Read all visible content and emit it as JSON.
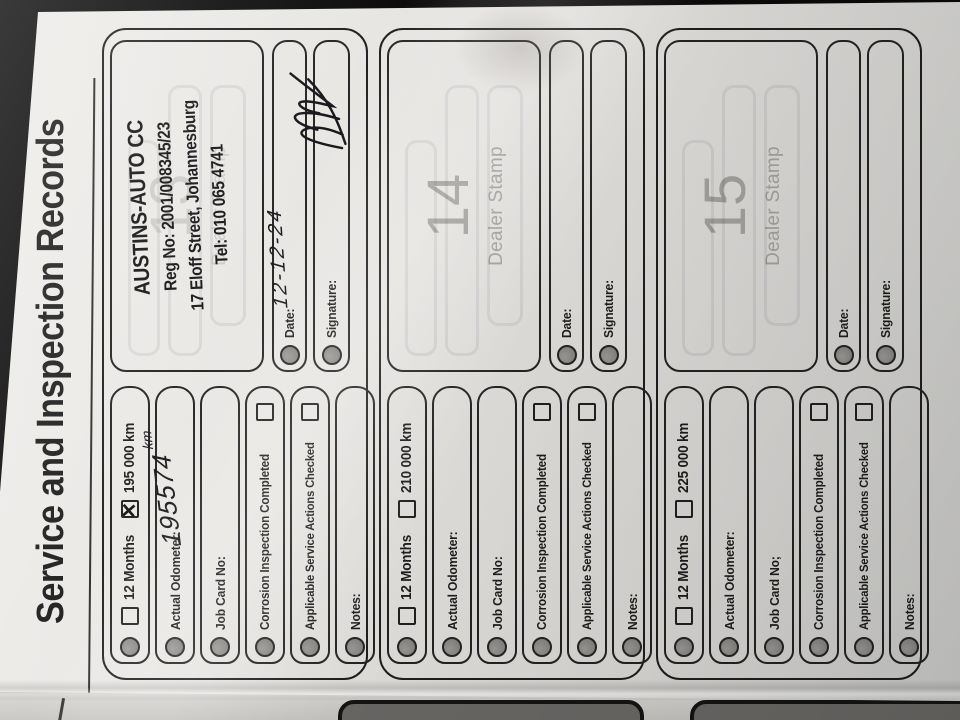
{
  "page": {
    "title": "Service and Inspection Records"
  },
  "records": [
    {
      "number": "13",
      "print_faint": true,
      "dealer_stamp_label": "Dealer Stamp",
      "has_stamp": true,
      "stamp": {
        "name": "AUSTINS-AUTO CC",
        "reg": "Reg No: 2001/008345/23",
        "street": "17 Eloff Street, Johannesburg",
        "tel": "Tel: 010 065 4741"
      },
      "fields": {
        "interval_label": "12 Months",
        "interval_checked": false,
        "km_label": "195 000 km",
        "km_checked": true,
        "odometer_label": "Actual Odometer:",
        "odometer_value": "195574",
        "odometer_unit": "km",
        "job_card_label": "Job Card No:",
        "corrosion_label": "Corrosion Inspection Completed",
        "corrosion_checked": false,
        "actions_label": "Applicable Service Actions Checked",
        "actions_checked": false,
        "notes_label": "Notes:"
      },
      "date_label": "Date:",
      "date_value": "12-12-24",
      "signature_label": "Signature:",
      "signature_present": true
    },
    {
      "number": "14",
      "print_faint": false,
      "dealer_stamp_label": "Dealer Stamp",
      "has_stamp": false,
      "stamp": {
        "name": "",
        "reg": "",
        "street": "",
        "tel": ""
      },
      "fields": {
        "interval_label": "12 Months",
        "interval_checked": false,
        "km_label": "210 000 km",
        "km_checked": false,
        "odometer_label": "Actual Odometer:",
        "odometer_value": "",
        "odometer_unit": "",
        "job_card_label": "Job Card No:",
        "corrosion_label": "Corrosion Inspection Completed",
        "corrosion_checked": false,
        "actions_label": "Applicable Service Actions Checked",
        "actions_checked": false,
        "notes_label": "Notes:"
      },
      "date_label": "Date:",
      "date_value": "",
      "signature_label": "Signature:",
      "signature_present": false
    },
    {
      "number": "15",
      "print_faint": false,
      "dealer_stamp_label": "Dealer Stamp",
      "has_stamp": false,
      "stamp": {
        "name": "",
        "reg": "",
        "street": "",
        "tel": ""
      },
      "fields": {
        "interval_label": "12 Months",
        "interval_checked": false,
        "km_label": "225 000 km",
        "km_checked": false,
        "odometer_label": "Actual Odometer:",
        "odometer_value": "",
        "odometer_unit": "",
        "job_card_label": "Job Card No;",
        "corrosion_label": "Corrosion Inspection Completed",
        "corrosion_checked": false,
        "actions_label": "Applicable Service Actions Checked",
        "actions_checked": false,
        "notes_label": "Notes:"
      },
      "date_label": "Date:",
      "date_value": "",
      "signature_label": "Signature:",
      "signature_present": false
    }
  ]
}
